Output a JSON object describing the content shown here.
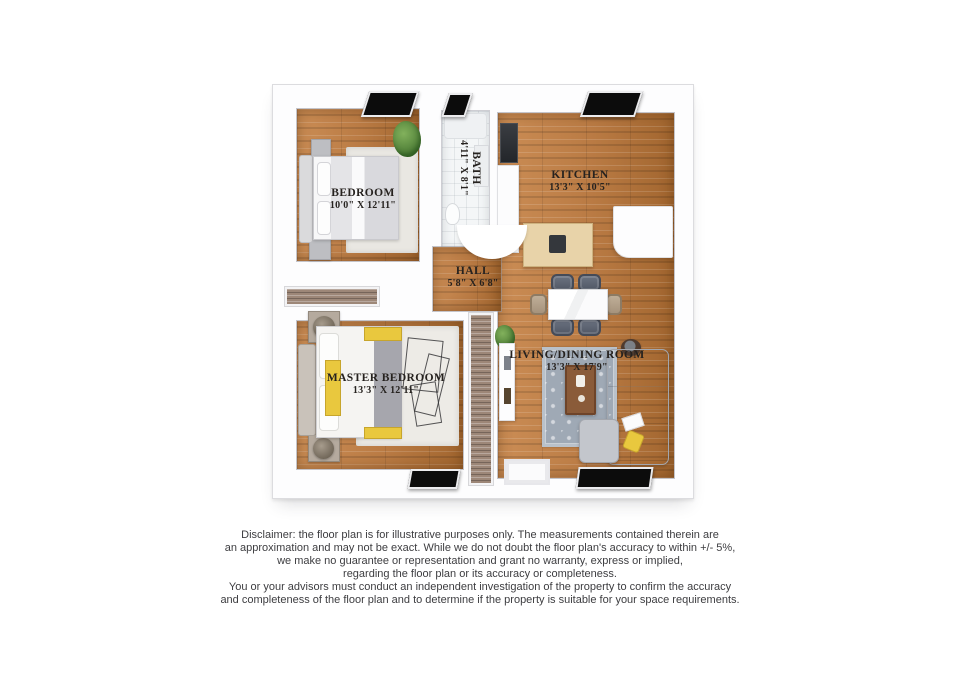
{
  "plan": {
    "rooms": [
      {
        "name": "BEDROOM",
        "dims": "10'0\" X 12'11\""
      },
      {
        "name": "BATH",
        "dims": "4'11\" X 8'1\""
      },
      {
        "name": "KITCHEN",
        "dims": "13'3\" X 10'5\""
      },
      {
        "name": "HALL",
        "dims": "5'8\" X 6'8\""
      },
      {
        "name": "MASTER BEDROOM",
        "dims": "13'3\" X 12'11\""
      },
      {
        "name": "LIVING/DINING ROOM",
        "dims": "13'3\" X 17'9\""
      }
    ]
  },
  "disclaimer": {
    "lines": [
      "Disclaimer: the floor plan is for illustrative purposes only. The measurements contained therein are",
      "an approximation and may not be exact. While we do not doubt the floor plan's accuracy to within +/- 5%,",
      "we make no guarantee or representation and grant no warranty, express or implied,",
      "regarding the floor plan or its accuracy or completeness.",
      "You or your advisors must conduct an independent investigation of the property to confirm the accuracy",
      "and completeness of the floor plan and to determine if the property is suitable for your space requirements."
    ]
  },
  "colors": {
    "wood": "#b97a43",
    "wood-light": "#cb8d55",
    "wood-dark": "#a2662f",
    "tile": "#f4f6f7",
    "window": "#0c0c0c",
    "accent-yellow": "#e9c83e",
    "sofa-gray": "#c3c6cc",
    "rug-gray": "#9fa9b5",
    "closet-wood": "#9d8778",
    "label-ink": "#26221f"
  }
}
